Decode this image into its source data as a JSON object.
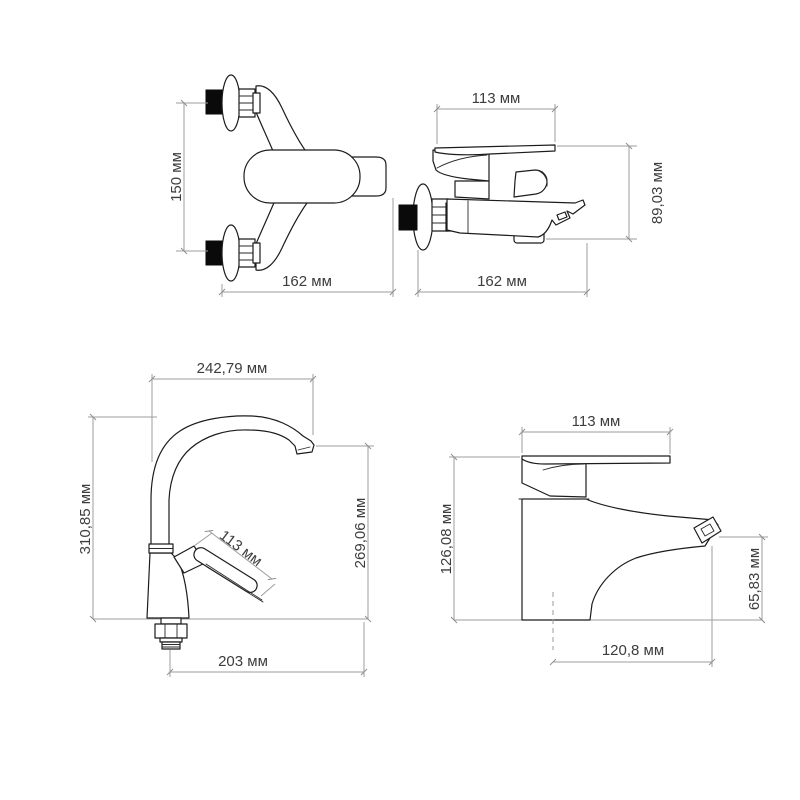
{
  "document": {
    "type": "technical-dimension-drawing",
    "unit": "мм",
    "background": "#ffffff"
  },
  "colors": {
    "outline": "#1c1c1c",
    "dimension_line": "#9c9c9c",
    "dimension_text": "#3d3d3d",
    "thread_fill": "#0a0a0a"
  },
  "views": {
    "bath_mixer_front": {
      "title": "wall-mounted bath mixer — front view",
      "dims": {
        "mount_spacing": "150 мм",
        "overall_width": "162 мм"
      }
    },
    "bath_mixer_side": {
      "title": "wall-mounted bath mixer — side view",
      "dims": {
        "body_depth": "113 мм",
        "body_height": "89,03 мм",
        "overall_depth": "162 мм"
      }
    },
    "kitchen_faucet": {
      "title": "kitchen faucet with high spout — side view",
      "dims": {
        "spout_reach_top": "242,79 мм",
        "overall_height": "310,85 мм",
        "spout_outlet_height": "269,06 мм",
        "handle_length": "113 мм",
        "base_reach": "203 мм"
      }
    },
    "basin_faucet": {
      "title": "basin faucet — side view",
      "dims": {
        "body_width": "113 мм",
        "overall_height": "126,08 мм",
        "spout_outlet_height": "65,83 мм",
        "spout_reach": "120,8 мм"
      }
    }
  }
}
